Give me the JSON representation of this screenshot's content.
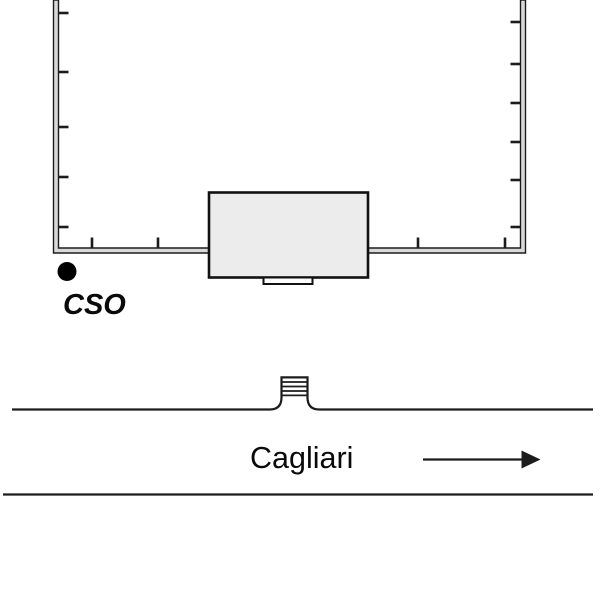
{
  "labels": {
    "marker": "CSO",
    "street": "Cagliari"
  },
  "colors": {
    "line": "#1c1c1c",
    "wall_fill": "#d9d9d9",
    "building_fill": "#ececec",
    "entrance_fill": "#ffffff",
    "marker_dot": "#000000",
    "background": "#ffffff"
  },
  "enclosure": {
    "left_wall_ticks_y": [
      13,
      72,
      127,
      177,
      227
    ],
    "right_wall_ticks_y": [
      22,
      64,
      103,
      142,
      180,
      227
    ],
    "bottom_wall_ticks_x": [
      92,
      158,
      418,
      505
    ]
  },
  "gate": {
    "steps_y": [
      382,
      386.5,
      391,
      395.4
    ]
  },
  "direction_arrow": {
    "direction": "right"
  }
}
